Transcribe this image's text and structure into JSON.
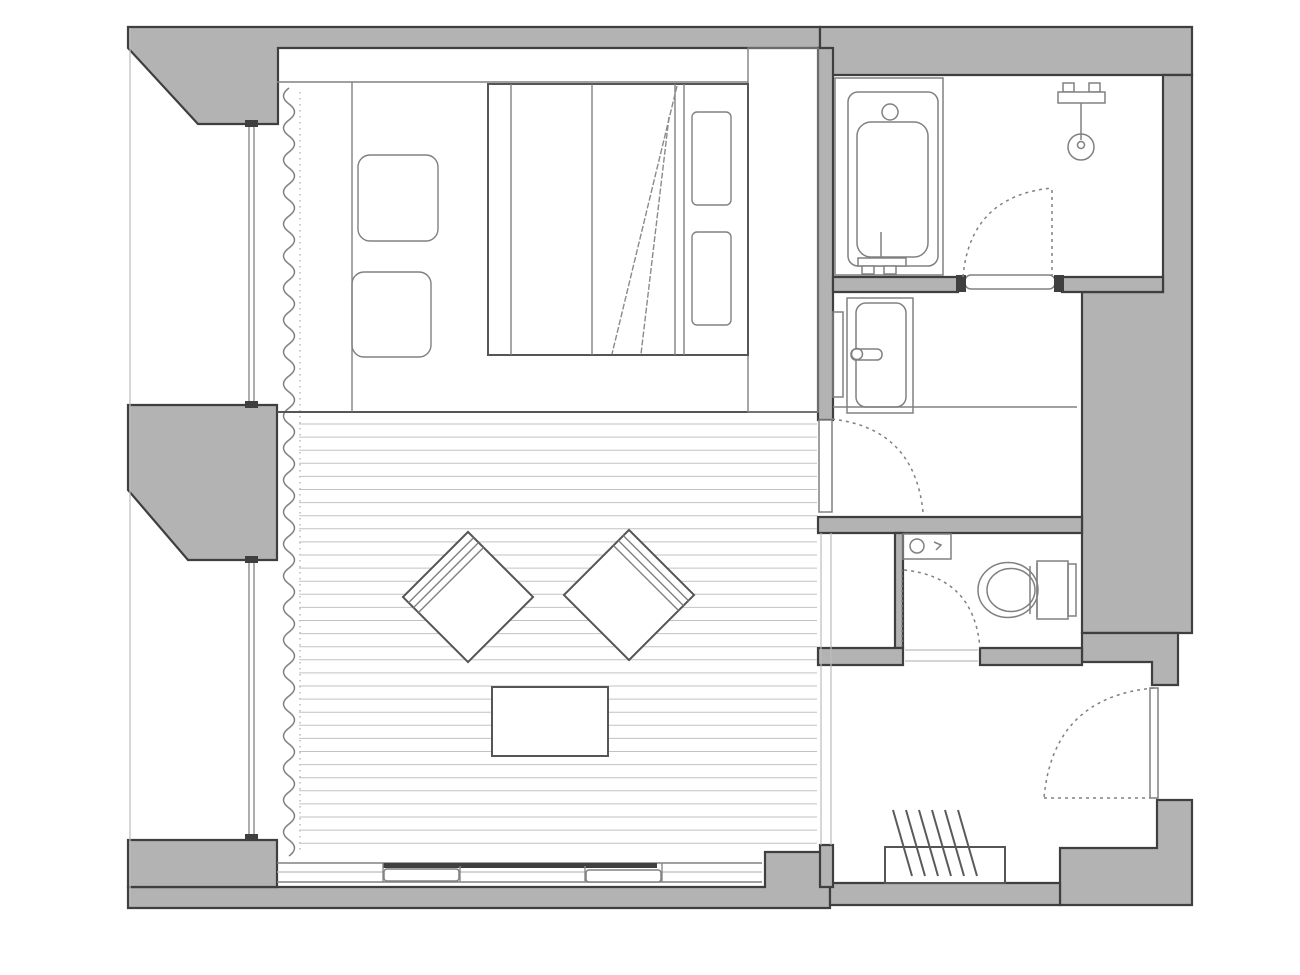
{
  "title": "",
  "colors": {
    "bg": "#ffffff",
    "wall_fill": "#b3b3b3",
    "wall_outline": "#3f3f3f",
    "line_strong": "#555555",
    "line_medium": "#808080",
    "line_light": "#bcbcbc"
  },
  "labels": {
    "plan": "hotel guest room floor plan",
    "bedroom": "bedroom area",
    "bed": "double bed",
    "pillow": "pillow",
    "side_table": "side table",
    "wardrobe": "wardrobe",
    "living": "living area with plank flooring",
    "chair": "lounge chair",
    "table": "coffee table",
    "curtain": "window curtain",
    "window": "window glazing",
    "bathroom": "bathroom",
    "bathtub": "bathtub",
    "shower": "shower fixture",
    "vanity": "vanity room",
    "sink": "wash basin",
    "toilet_room": "toilet room",
    "toilet": "toilet",
    "hand_basin": "hand wash basin",
    "entry": "entry hall",
    "step": "entry step with hatching",
    "entry_door": "entrance door",
    "door": "interior door swing"
  },
  "geometry_notes": {
    "canvas": [
      1300,
      975
    ],
    "plank_area": {
      "x1": 299,
      "x2": 817,
      "y1": 424,
      "y2": 856,
      "spacing": 13.1
    },
    "curtain": {
      "x": 289,
      "y1": 88,
      "y2": 852,
      "scallop": 16,
      "amp": 11
    },
    "hatch": {
      "x0": 893,
      "count": 6,
      "dx": 13,
      "ytop": 810,
      "ybot": 876,
      "slant": 19
    }
  }
}
